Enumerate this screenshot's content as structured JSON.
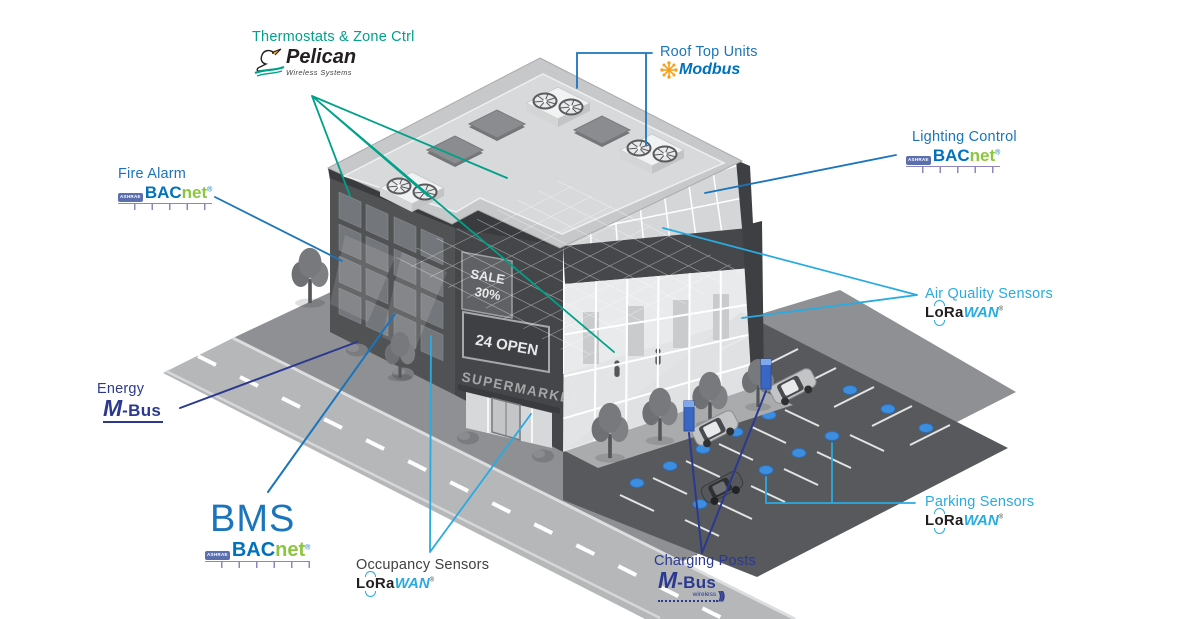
{
  "colors": {
    "teal": "#00A189",
    "blue": "#1B75BC",
    "cyan": "#29ABE2",
    "navy": "#2B3990",
    "bacnet_blue": "#0072BC",
    "bacnet_green": "#8CC63E",
    "modbus_orange": "#F6A21E",
    "lorawan_black": "#231F20",
    "sensor_dot_blue": "#3E8EE0",
    "dark_text": "#414042"
  },
  "logos": {
    "bacnet": {
      "badge": "ASHRAE",
      "p1": "BAC",
      "p2": "net"
    },
    "lorawan": {
      "p1": "LoRa",
      "p2": "WAN"
    },
    "mbus": {
      "m": "M",
      "rest": "-Bus",
      "wireless": "wireless"
    },
    "modbus": {
      "text": "Modbus"
    },
    "pelican": {
      "text": "Pelican",
      "sub": "Wireless Systems"
    }
  },
  "annotations": {
    "thermostats": {
      "title": "Thermostats & Zone Ctrl",
      "protocol": "Pelican Wireless Systems"
    },
    "rooftop": {
      "title": "Roof Top Units",
      "protocol": "Modbus"
    },
    "fire_alarm": {
      "title": "Fire Alarm",
      "protocol": "BACnet"
    },
    "lighting": {
      "title": "Lighting Control",
      "protocol": "BACnet"
    },
    "air_quality": {
      "title": "Air Quality Sensors",
      "protocol": "LoRaWAN"
    },
    "energy": {
      "title": "Energy",
      "protocol": "M-Bus"
    },
    "bms": {
      "title": "BMS",
      "protocol": "BACnet"
    },
    "occupancy": {
      "title": "Occupancy Sensors",
      "protocol": "LoRaWAN"
    },
    "charging": {
      "title": "Charging Posts",
      "protocol": "M-Bus wireless"
    },
    "parking": {
      "title": "Parking Sensors",
      "protocol": "LoRaWAN"
    }
  },
  "building": {
    "signs": {
      "sale_top": "SALE",
      "sale_bottom": "30%",
      "open": "24 OPEN",
      "storefront": "SUPERMARKET"
    }
  },
  "scene": {
    "rooftop_unit_count": 3,
    "skylight_count": 3,
    "charging_post_count": 2,
    "car_count": 3,
    "parking_sensor_dot_count": 13,
    "tree_count": 6
  }
}
